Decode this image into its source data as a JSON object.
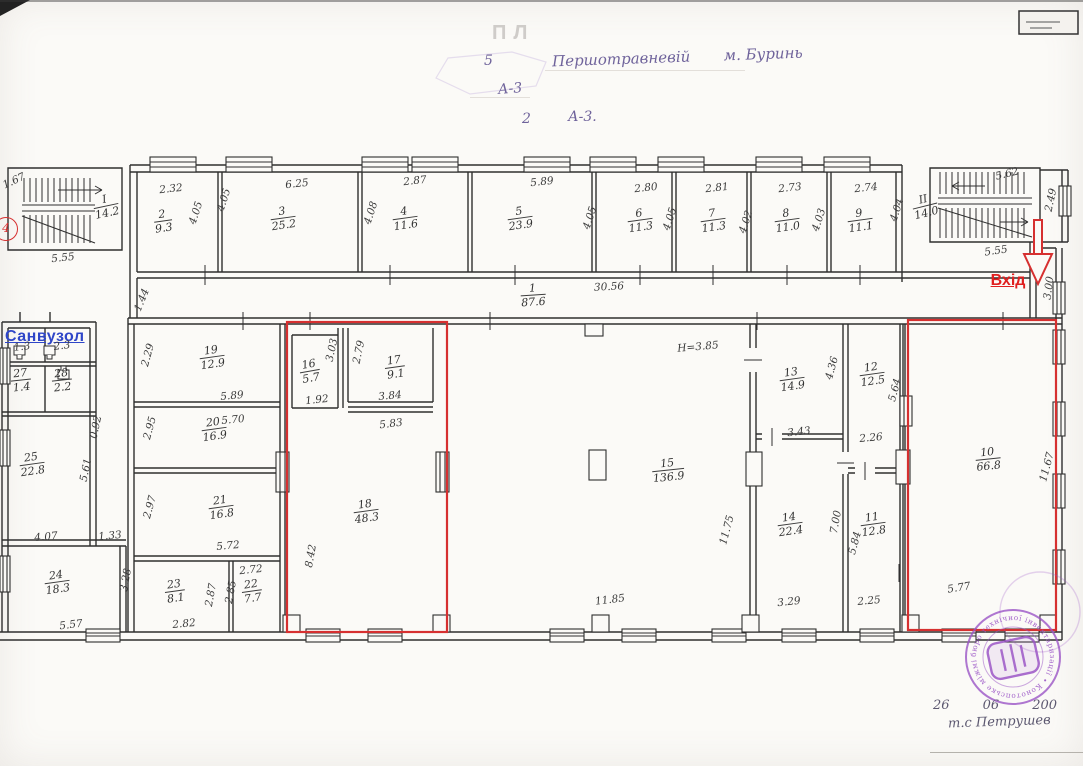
{
  "document": {
    "header": {
      "line1_left": "5",
      "line1_right": "Першотравневій       м. Буринь",
      "line2": "А-3",
      "line3_left": "2",
      "line3_right": "А-3.",
      "faded_text": "ПЛ"
    },
    "annotations": {
      "entrance": "Вхід",
      "sanitary": "Санвузол",
      "marker": "4"
    },
    "stamp": {
      "ring_text": "бюро технічної інвентаризації • Конотопське міжміське бюро технічної інвентаризації •",
      "date_line": "26        06        200",
      "signature": "т.с  Петрушев"
    },
    "colors": {
      "highlight_red": "#d63030",
      "label_blue": "#2f46c8",
      "stamp_purple": "#9b55c6",
      "ink": "#333333"
    }
  },
  "plan": {
    "rooms": [
      {
        "num": "1",
        "area": "87.6",
        "x": 533,
        "y": 296,
        "r": -4
      },
      {
        "num": "2",
        "area": "9.3",
        "x": 163,
        "y": 222,
        "r": -8
      },
      {
        "num": "3",
        "area": "25.2",
        "x": 283,
        "y": 219,
        "r": -8
      },
      {
        "num": "4",
        "area": "11.6",
        "x": 405,
        "y": 219,
        "r": -8
      },
      {
        "num": "5",
        "area": "23.9",
        "x": 520,
        "y": 219,
        "r": -8
      },
      {
        "num": "6",
        "area": "11.3",
        "x": 640,
        "y": 221,
        "r": -8
      },
      {
        "num": "7",
        "area": "11.3",
        "x": 713,
        "y": 221,
        "r": -8
      },
      {
        "num": "8",
        "area": "11.0",
        "x": 787,
        "y": 221,
        "r": -8
      },
      {
        "num": "9",
        "area": "11.1",
        "x": 860,
        "y": 221,
        "r": -8
      },
      {
        "num": "10",
        "area": "66.8",
        "x": 988,
        "y": 460,
        "r": -6
      },
      {
        "num": "11",
        "area": "12.8",
        "x": 873,
        "y": 525,
        "r": -8
      },
      {
        "num": "12",
        "area": "12.5",
        "x": 872,
        "y": 375,
        "r": -8
      },
      {
        "num": "13",
        "area": "14.9",
        "x": 792,
        "y": 380,
        "r": -8
      },
      {
        "num": "14",
        "area": "22.4",
        "x": 790,
        "y": 525,
        "r": -8
      },
      {
        "num": "15",
        "area": "136.9",
        "x": 668,
        "y": 471,
        "r": -6
      },
      {
        "num": "16",
        "area": "5.7",
        "x": 310,
        "y": 372,
        "r": -10
      },
      {
        "num": "17",
        "area": "9.1",
        "x": 395,
        "y": 368,
        "r": -8
      },
      {
        "num": "18",
        "area": "48.3",
        "x": 366,
        "y": 512,
        "r": -8
      },
      {
        "num": "19",
        "area": "12.9",
        "x": 212,
        "y": 358,
        "r": -8
      },
      {
        "num": "20",
        "area": "16.9",
        "x": 214,
        "y": 430,
        "r": -8
      },
      {
        "num": "21",
        "area": "16.8",
        "x": 221,
        "y": 508,
        "r": -8
      },
      {
        "num": "22",
        "area": "7.7",
        "x": 252,
        "y": 592,
        "r": -8
      },
      {
        "num": "23",
        "area": "8.1",
        "x": 175,
        "y": 592,
        "r": -8
      },
      {
        "num": "24",
        "area": "18.3",
        "x": 57,
        "y": 583,
        "r": -8
      },
      {
        "num": "25",
        "area": "22.8",
        "x": 32,
        "y": 465,
        "r": -8
      },
      {
        "num": "27",
        "area": "1.4",
        "x": 21,
        "y": 381,
        "r": -6
      },
      {
        "num": "28",
        "area": "2.2",
        "x": 62,
        "y": 381,
        "r": -6
      },
      {
        "num": "І",
        "area": "14.2",
        "x": 106,
        "y": 207,
        "r": -12
      },
      {
        "num": "ІІ",
        "area": "14.0",
        "x": 925,
        "y": 207,
        "r": -14
      }
    ],
    "dims": [
      {
        "t": "1.67",
        "x": 14,
        "y": 181,
        "r": -25
      },
      {
        "t": "5.55",
        "x": 63,
        "y": 258,
        "r": -6
      },
      {
        "t": "2.32",
        "x": 171,
        "y": 189,
        "r": -6
      },
      {
        "t": "4.05",
        "x": 196,
        "y": 213,
        "r": -72
      },
      {
        "t": "4.05",
        "x": 224,
        "y": 200,
        "r": -72
      },
      {
        "t": "6.25",
        "x": 297,
        "y": 184,
        "r": -6
      },
      {
        "t": "2.87",
        "x": 415,
        "y": 181,
        "r": -6
      },
      {
        "t": "4.08",
        "x": 371,
        "y": 213,
        "r": -72
      },
      {
        "t": "5.89",
        "x": 542,
        "y": 182,
        "r": -6
      },
      {
        "t": "4.05",
        "x": 590,
        "y": 218,
        "r": -72
      },
      {
        "t": "2.80",
        "x": 646,
        "y": 188,
        "r": -6
      },
      {
        "t": "4.05",
        "x": 670,
        "y": 219,
        "r": -72
      },
      {
        "t": "2.81",
        "x": 717,
        "y": 188,
        "r": -6
      },
      {
        "t": "4.02",
        "x": 746,
        "y": 222,
        "r": -72
      },
      {
        "t": "2.73",
        "x": 790,
        "y": 188,
        "r": -6
      },
      {
        "t": "4.03",
        "x": 819,
        "y": 220,
        "r": -72
      },
      {
        "t": "2.74",
        "x": 866,
        "y": 188,
        "r": -6
      },
      {
        "t": "4.04",
        "x": 897,
        "y": 210,
        "r": -72
      },
      {
        "t": "5.62",
        "x": 1007,
        "y": 174,
        "r": -14
      },
      {
        "t": "2.49",
        "x": 1051,
        "y": 200,
        "r": -78
      },
      {
        "t": "5.55",
        "x": 996,
        "y": 251,
        "r": -8
      },
      {
        "t": "3.00",
        "x": 1049,
        "y": 288,
        "r": -82
      },
      {
        "t": "30.56",
        "x": 609,
        "y": 287,
        "r": -3
      },
      {
        "t": "1.44",
        "x": 142,
        "y": 300,
        "r": -68
      },
      {
        "t": "1.3",
        "x": 22,
        "y": 347,
        "r": -6
      },
      {
        "t": "2.3",
        "x": 62,
        "y": 346,
        "r": -6
      },
      {
        "t": "0.92",
        "x": 96,
        "y": 427,
        "r": -78
      },
      {
        "t": "5.61",
        "x": 86,
        "y": 470,
        "r": -78
      },
      {
        "t": "4.07",
        "x": 46,
        "y": 537,
        "r": -5
      },
      {
        "t": "1.33",
        "x": 110,
        "y": 536,
        "r": -5
      },
      {
        "t": "5.57",
        "x": 71,
        "y": 625,
        "r": -7
      },
      {
        "t": "3.28",
        "x": 126,
        "y": 580,
        "r": -80
      },
      {
        "t": "2.29",
        "x": 148,
        "y": 355,
        "r": -75
      },
      {
        "t": "5.89",
        "x": 232,
        "y": 396,
        "r": -5
      },
      {
        "t": "5.70",
        "x": 233,
        "y": 420,
        "r": -5
      },
      {
        "t": "2.95",
        "x": 150,
        "y": 428,
        "r": -75
      },
      {
        "t": "2.97",
        "x": 150,
        "y": 507,
        "r": -75
      },
      {
        "t": "5.72",
        "x": 228,
        "y": 546,
        "r": -5
      },
      {
        "t": "2.72",
        "x": 251,
        "y": 570,
        "r": -6
      },
      {
        "t": "2.87",
        "x": 211,
        "y": 595,
        "r": -80
      },
      {
        "t": "2.85",
        "x": 231,
        "y": 592,
        "r": -80
      },
      {
        "t": "2.82",
        "x": 184,
        "y": 624,
        "r": -5
      },
      {
        "t": "3.03",
        "x": 332,
        "y": 350,
        "r": -78
      },
      {
        "t": "2.79",
        "x": 359,
        "y": 352,
        "r": -78
      },
      {
        "t": "1.92",
        "x": 317,
        "y": 400,
        "r": -6
      },
      {
        "t": "3.84",
        "x": 390,
        "y": 396,
        "r": -5
      },
      {
        "t": "5.83",
        "x": 391,
        "y": 424,
        "r": -7
      },
      {
        "t": "8.42",
        "x": 311,
        "y": 556,
        "r": -80
      },
      {
        "t": "Н=3.85",
        "x": 698,
        "y": 347,
        "r": -5
      },
      {
        "t": "11.75",
        "x": 727,
        "y": 530,
        "r": -75
      },
      {
        "t": "11.85",
        "x": 610,
        "y": 600,
        "r": -7
      },
      {
        "t": "4.36",
        "x": 832,
        "y": 368,
        "r": -75
      },
      {
        "t": "3.43",
        "x": 799,
        "y": 432,
        "r": -6
      },
      {
        "t": "5.64",
        "x": 895,
        "y": 390,
        "r": -75
      },
      {
        "t": "2.26",
        "x": 871,
        "y": 438,
        "r": -5
      },
      {
        "t": "7.00",
        "x": 836,
        "y": 522,
        "r": -80
      },
      {
        "t": "5.84",
        "x": 855,
        "y": 543,
        "r": -75
      },
      {
        "t": "3.29",
        "x": 789,
        "y": 602,
        "r": -6
      },
      {
        "t": "2.25",
        "x": 869,
        "y": 601,
        "r": -5
      },
      {
        "t": "11.67",
        "x": 1047,
        "y": 467,
        "r": -75
      },
      {
        "t": "5.77",
        "x": 959,
        "y": 588,
        "r": -9
      }
    ]
  }
}
